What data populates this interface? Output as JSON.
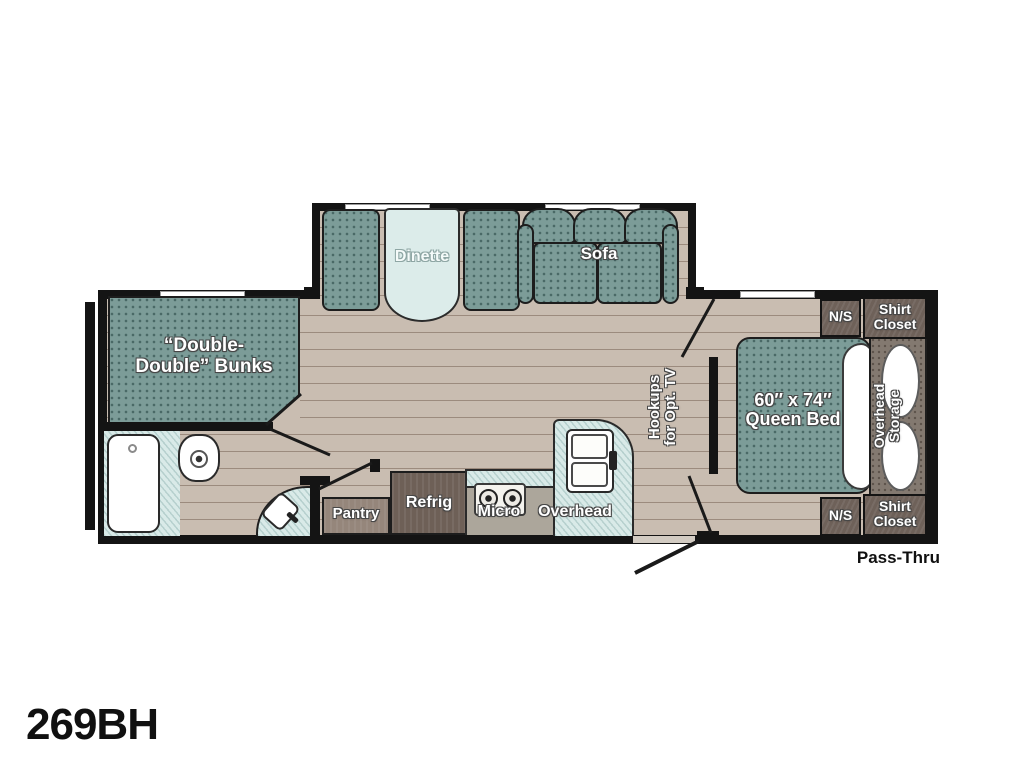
{
  "title": {
    "model": "269BH"
  },
  "floorplan": {
    "slideout": {
      "dinette_label": "Dinette",
      "sofa_label": "Sofa"
    },
    "bunks": {
      "line1": "“Double-",
      "line2": "Double” Bunks"
    },
    "bathroom": {},
    "kitchen": {
      "pantry_label": "Pantry",
      "refrig_label": "Refrig",
      "micro_label": "Micro",
      "overhead_label": "Overhead"
    },
    "bedroom": {
      "bed_line1": "60″ x 74″",
      "bed_line2": "Queen Bed",
      "overhead_storage_line1": "Overhead",
      "overhead_storage_line2": "Storage",
      "nightstand_top": "N/S",
      "nightstand_bottom": "N/S",
      "closet_top_line1": "Shirt",
      "closet_top_line2": "Closet",
      "closet_bottom_line1": "Shirt",
      "closet_bottom_line2": "Closet",
      "tv_line1": "Hookups",
      "tv_line2": "for Opt. TV"
    },
    "pass_thru_label": "Pass-Thru"
  },
  "colors": {
    "teal": "#7c9c98",
    "floor": "#c9bdb1",
    "wall": "#141414",
    "counter": "#d9eae8",
    "cabinet_dark": "#6e6057",
    "cabinet_mid": "#95867b",
    "storage_gray": "#837970"
  }
}
